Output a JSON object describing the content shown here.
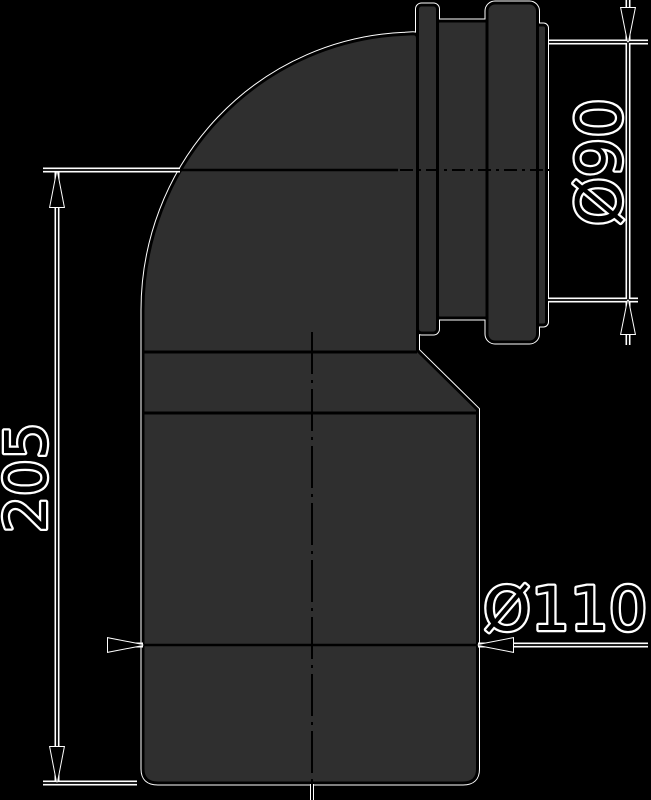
{
  "drawing": {
    "type": "technical-drawing",
    "subject": "90-degree pipe elbow with socket",
    "dimensions": {
      "overall_height": {
        "label": "205"
      },
      "socket_diameter": {
        "label": "Ø90"
      },
      "outlet_diameter": {
        "label": "Ø110"
      }
    },
    "colors": {
      "background": "#000000",
      "part_fill": "#2f2f2f",
      "line": "#000000",
      "halo": "#ffffff"
    }
  }
}
